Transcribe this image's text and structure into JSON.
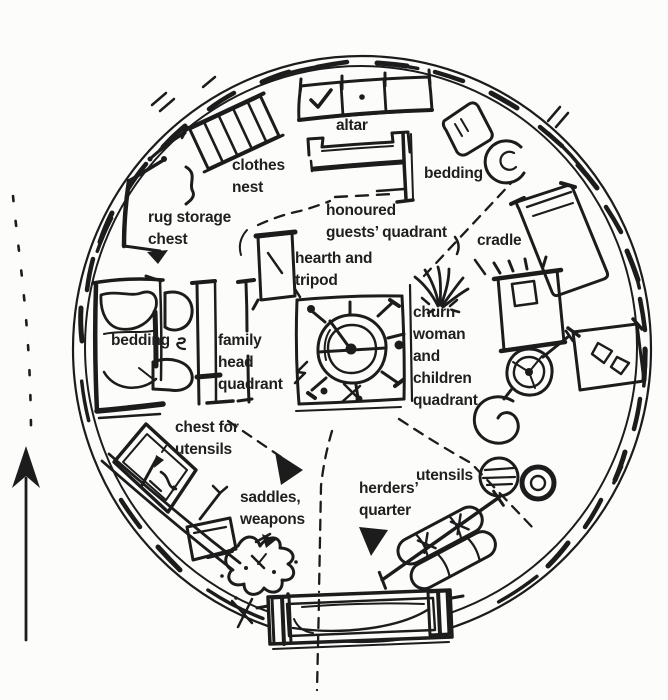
{
  "page": {
    "paper_color": "#fcfcfa",
    "ink_color": "#1c1c1c",
    "description": "Hand-drawn floor plan sketch of a yurt interior with quadrant labels"
  },
  "diagram": {
    "labels": {
      "altar": "altar",
      "clothes_nest": "clothes\nnest",
      "rug_storage_chest": "rug storage\nchest",
      "bedding_ne": "bedding",
      "honoured_guests": "honoured\nguests’ quadrant",
      "cradle": "cradle",
      "hearth_tripod": "hearth and\ntripod",
      "churn_quadrant": "churn\nwoman\nand\nchildren\nquadrant",
      "bedding_w": "bedding",
      "family_head": "family\nhead\nquadrant",
      "chest_utensils": "chest for\nutensils",
      "saddles_weapons": "saddles,\nweapons",
      "herders_quarter": "herders’\nquarter",
      "utensils": "utensils"
    }
  }
}
